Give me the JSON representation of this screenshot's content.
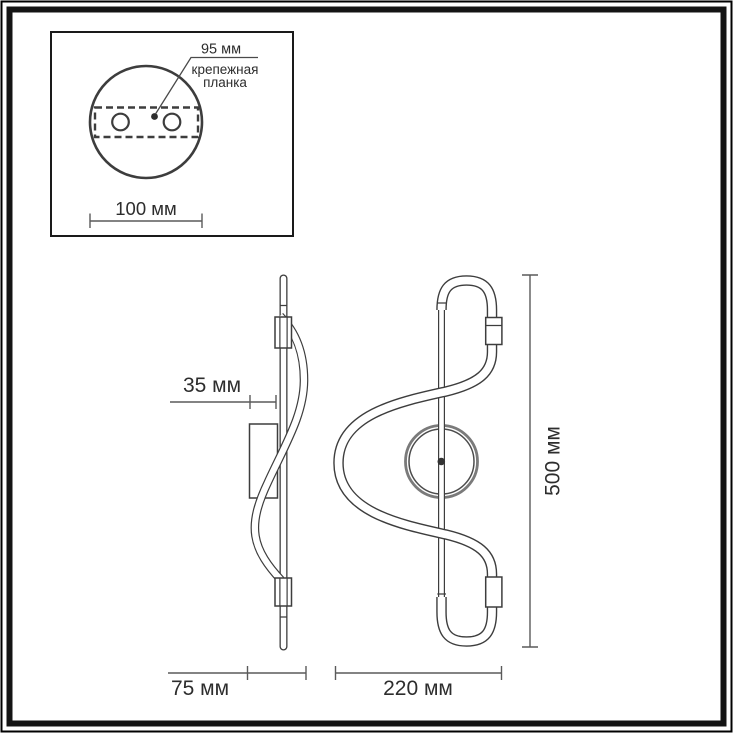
{
  "inset": {
    "hole_spacing_label": "95 мм",
    "mounting_bar_label_line1": "крепежная",
    "mounting_bar_label_line2": "планка",
    "plate_width_label": "100 мм"
  },
  "side_view": {
    "wall_offset_label": "35 мм",
    "depth_label": "75 мм"
  },
  "front_view": {
    "width_label": "220 мм",
    "height_label": "500 мм"
  },
  "colors": {
    "outline": "#3d3d3d",
    "dimension_line": "#5a5a5a",
    "text": "#2d2d2d",
    "background": "#ffffff",
    "frame": "#141414"
  }
}
